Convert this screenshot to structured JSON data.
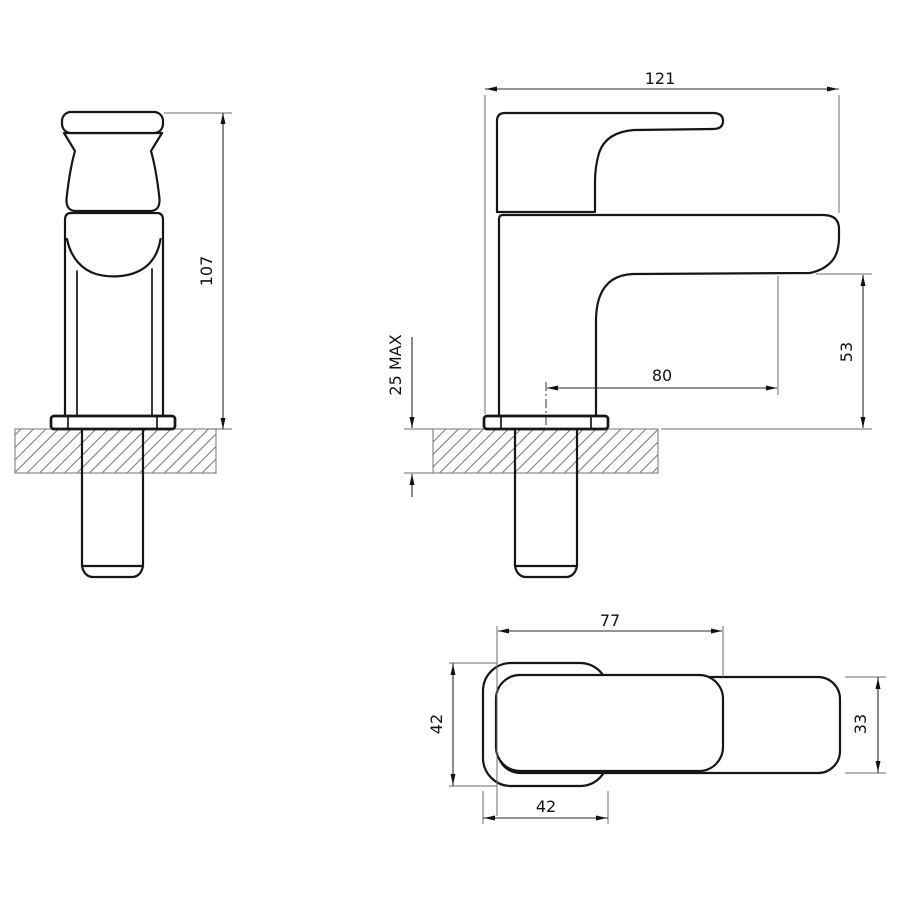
{
  "drawing": {
    "product": "basin-tap-technical-drawing",
    "views": {
      "front": {
        "dim_height": "107"
      },
      "side": {
        "dim_overall_length": "121",
        "dim_spout_reach": "80",
        "dim_spout_height": "53",
        "dim_max_deck_thickness": "25 MAX"
      },
      "top": {
        "dim_handle_length": "77",
        "dim_base_width": "42",
        "dim_base_depth": "42",
        "dim_spout_width": "33"
      }
    },
    "colors": {
      "line": "#161616",
      "dimension": "#2b2b2b",
      "extension": "#6e6e6e",
      "hatch": "#787878",
      "background": "#ffffff"
    }
  }
}
